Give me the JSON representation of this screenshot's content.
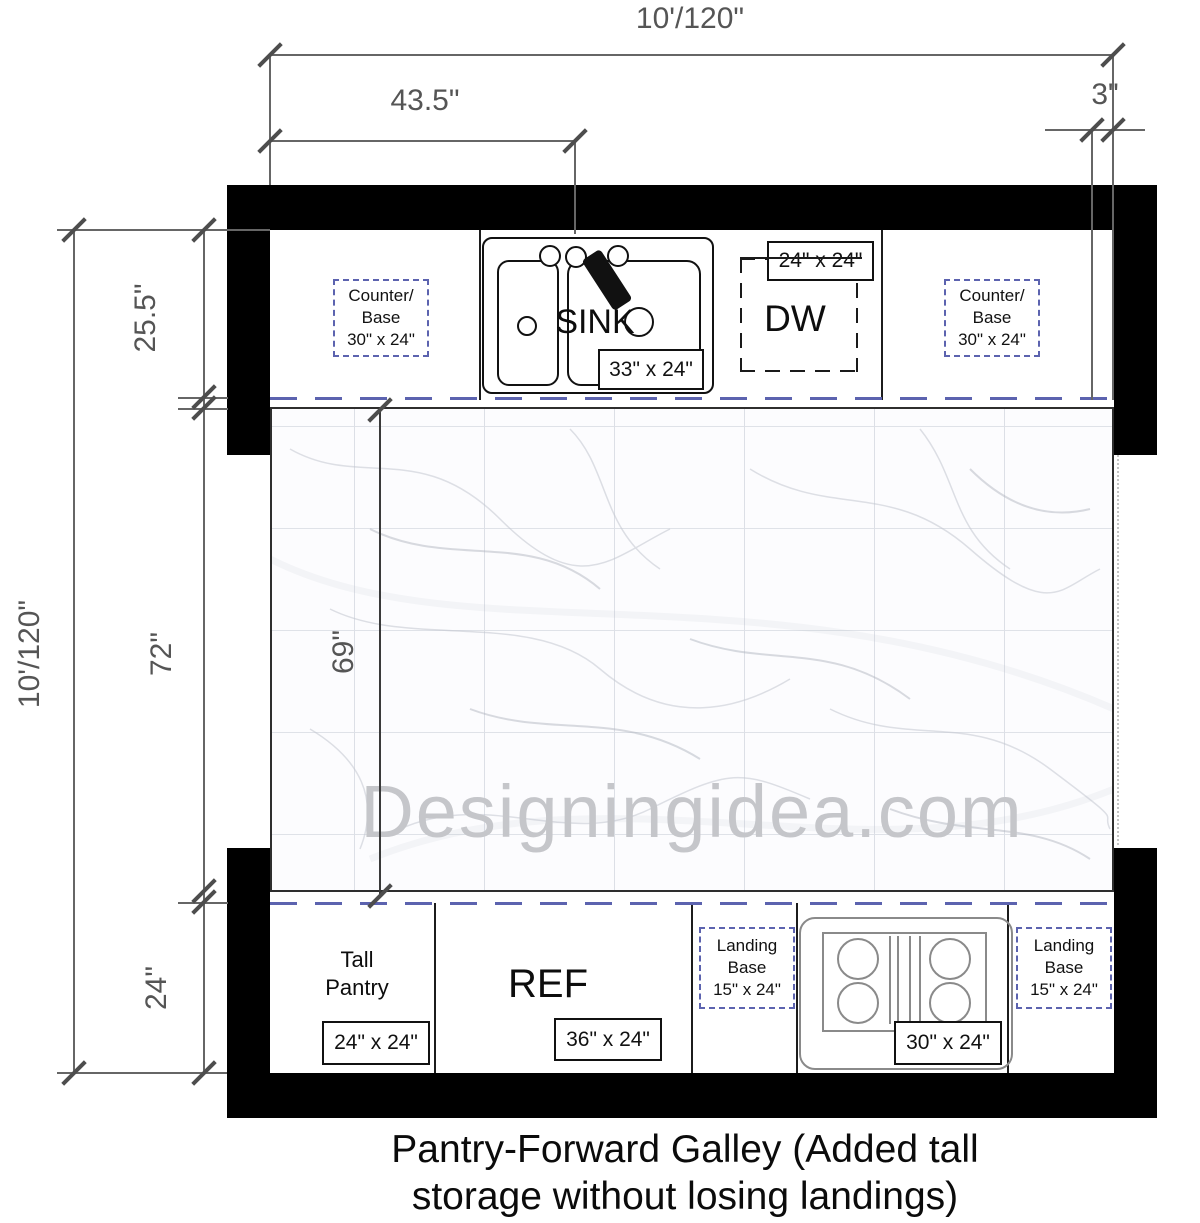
{
  "plan": {
    "caption": [
      "Pantry-Forward Galley (Added tall",
      "storage without losing landings)"
    ],
    "watermark": "Designingidea.com",
    "dims": {
      "overall_top": "10'/120\"",
      "overall_left": "10'/120\"",
      "sink_center": "43.5\"",
      "filler_right": "3\"",
      "counter_depth": "25.5\"",
      "aisle_width": "72\"",
      "floor_clear": "69\"",
      "base_depth": "24\""
    },
    "top_run": {
      "counter_left": [
        "Counter/",
        "Base",
        "30\" x 24\""
      ],
      "sink_label": "SINK",
      "sink_size": "33\" x 24\"",
      "dw_label": "DW",
      "dw_size": "24\" x 24\"",
      "counter_right": [
        "Counter/",
        "Base",
        "30\" x 24\""
      ]
    },
    "bottom_run": {
      "pantry": [
        "Tall",
        "Pantry"
      ],
      "pantry_size": "24\" x 24\"",
      "ref_label": "REF",
      "ref_size": "36\" x 24\"",
      "landing_left": [
        "Landing",
        "Base",
        "15\" x 24\""
      ],
      "cooktop_size": "30\" x 24\"",
      "landing_right": [
        "Landing",
        "Base",
        "15\" x 24\""
      ]
    },
    "colors": {
      "accent": "#5c63af",
      "wall": "#000000",
      "dim_text": "#555555"
    }
  }
}
